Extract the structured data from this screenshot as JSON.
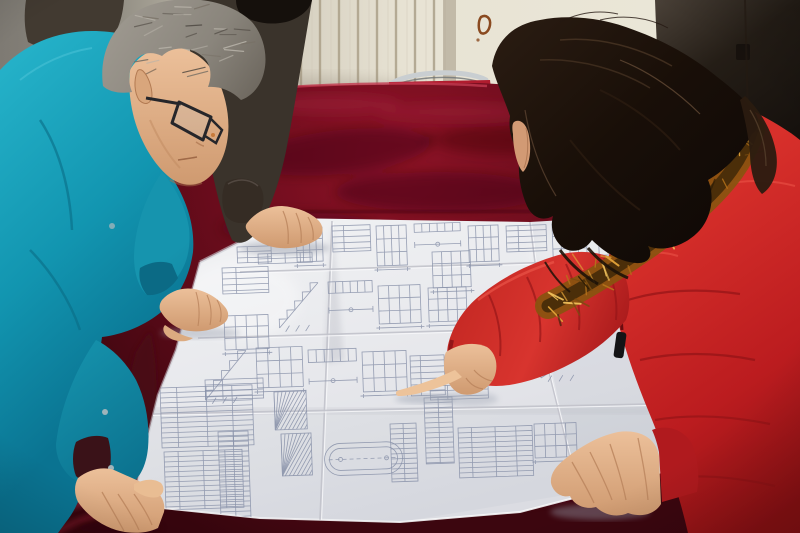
{
  "meta": {
    "description": "Photograph: two people leaning over a large folded architectural blueprint spread on a table covered with dark red velvet; a man in a teal work jacket with glasses on the left, a woman in a red fur-trimmed parka pointing at the drawing on the right, a third person in a dark coat partially visible behind.",
    "width": 800,
    "height": 533
  },
  "scene": {
    "people": [
      {
        "id": "engineer-left",
        "label": "man in teal work jacket, gray hair, dark glasses, leaning on the drawing"
      },
      {
        "id": "colleague-behind",
        "label": "person in dark coat behind, right hand resting on the drawing"
      },
      {
        "id": "woman-right",
        "label": "woman in red quilted parka with orange fur hood, long dark hair, pointing at the drawing"
      }
    ],
    "objects": [
      {
        "id": "blueprint",
        "label": "large folded construction drawing sheet with stair, beam and table details"
      },
      {
        "id": "velvet-table",
        "label": "table draped with dark red velvet cloth"
      },
      {
        "id": "red-chair",
        "label": "red upholstered chair with chrome tube frame behind the table"
      },
      {
        "id": "striped-wall",
        "label": "cream wall panel with vertical grooves"
      },
      {
        "id": "dark-door",
        "label": "dark door panel on the right"
      },
      {
        "id": "wall-stain",
        "label": "small rust stain on the wall"
      }
    ]
  },
  "palette": {
    "wall_left": "#868279",
    "wall_panel": "#d6d0c1",
    "wall_bright": "#e9e4d5",
    "wall_stripe": "#a89c85",
    "door_dark": "#17110d",
    "velvet": "#670c1c",
    "velvet_dark": "#3c060f",
    "velvet_bright": "#b62844",
    "chair_red": "#b01c2e",
    "chrome": "#c9ced1",
    "paper": "#e9eaee",
    "paper_shadow": "#c8c9d0",
    "ink": "#8790a8",
    "teal": "#18a0b8",
    "teal_shadow": "#0b6a85",
    "dark_coat": "#3a332b",
    "hair_gray": "#938e85",
    "hair_black": "#15100c",
    "fur_mid": "#8a5310",
    "fur_dark": "#3f2808",
    "coat_red": "#c4201f",
    "coat_red_dark": "#8e1216",
    "coat_red_light": "#ef5a4c",
    "skin": "#e2af87",
    "skin_shadow": "#b9835c",
    "stain": "#8a4a20"
  },
  "blueprint": {
    "folds": [
      [
        332,
        221,
        320,
        520
      ],
      [
        530,
        222,
        548,
        368
      ],
      [
        548,
        368,
        578,
        490
      ],
      [
        240,
        272,
        652,
        259
      ],
      [
        198,
        338,
        658,
        325
      ],
      [
        150,
        414,
        648,
        404
      ]
    ],
    "clusters": [
      {
        "x": 296,
        "y": 228,
        "w": 26,
        "h": 34,
        "t": "grid"
      },
      {
        "x": 332,
        "y": 226,
        "w": 38,
        "h": 26,
        "t": "rows"
      },
      {
        "x": 376,
        "y": 226,
        "w": 30,
        "h": 40,
        "t": "grid"
      },
      {
        "x": 414,
        "y": 224,
        "w": 46,
        "h": 28,
        "t": "beam"
      },
      {
        "x": 468,
        "y": 226,
        "w": 30,
        "h": 36,
        "t": "grid"
      },
      {
        "x": 506,
        "y": 226,
        "w": 40,
        "h": 26,
        "t": "rows"
      },
      {
        "x": 552,
        "y": 224,
        "w": 34,
        "h": 38,
        "t": "grid"
      },
      {
        "x": 598,
        "y": 221,
        "w": 42,
        "h": 52,
        "t": "grid"
      },
      {
        "x": 237,
        "y": 247,
        "w": 34,
        "h": 16,
        "t": "rows"
      },
      {
        "x": 258,
        "y": 254,
        "w": 54,
        "h": 10,
        "t": "table"
      },
      {
        "x": 222,
        "y": 268,
        "w": 46,
        "h": 26,
        "t": "rows"
      },
      {
        "x": 224,
        "y": 316,
        "w": 44,
        "h": 34,
        "t": "grid"
      },
      {
        "x": 278,
        "y": 284,
        "w": 40,
        "h": 44,
        "t": "stair"
      },
      {
        "x": 328,
        "y": 282,
        "w": 44,
        "h": 38,
        "t": "beam"
      },
      {
        "x": 378,
        "y": 286,
        "w": 42,
        "h": 38,
        "t": "grid"
      },
      {
        "x": 428,
        "y": 288,
        "w": 38,
        "h": 34,
        "t": "grid"
      },
      {
        "x": 432,
        "y": 252,
        "w": 38,
        "h": 36,
        "t": "grid"
      },
      {
        "x": 204,
        "y": 352,
        "w": 42,
        "h": 48,
        "t": "stair"
      },
      {
        "x": 256,
        "y": 348,
        "w": 46,
        "h": 40,
        "t": "grid"
      },
      {
        "x": 308,
        "y": 350,
        "w": 48,
        "h": 42,
        "t": "beam"
      },
      {
        "x": 362,
        "y": 352,
        "w": 44,
        "h": 40,
        "t": "grid"
      },
      {
        "x": 410,
        "y": 356,
        "w": 34,
        "h": 40,
        "t": "rows"
      },
      {
        "x": 520,
        "y": 318,
        "w": 28,
        "h": 38,
        "t": "ruler"
      },
      {
        "x": 540,
        "y": 352,
        "w": 44,
        "h": 26,
        "t": "stair"
      },
      {
        "x": 558,
        "y": 310,
        "w": 26,
        "h": 34,
        "t": "rows"
      },
      {
        "x": 430,
        "y": 386,
        "w": 58,
        "h": 14,
        "t": "rows"
      },
      {
        "x": 160,
        "y": 388,
        "w": 92,
        "h": 60,
        "t": "table"
      },
      {
        "x": 164,
        "y": 452,
        "w": 78,
        "h": 58,
        "t": "table"
      },
      {
        "x": 218,
        "y": 432,
        "w": 30,
        "h": 92,
        "t": "ruler"
      },
      {
        "x": 205,
        "y": 380,
        "w": 58,
        "h": 20,
        "t": "rows"
      },
      {
        "x": 274,
        "y": 392,
        "w": 32,
        "h": 38,
        "t": "hatch"
      },
      {
        "x": 281,
        "y": 434,
        "w": 30,
        "h": 42,
        "t": "hatch"
      },
      {
        "x": 324,
        "y": 444,
        "w": 78,
        "h": 32,
        "t": "oval"
      },
      {
        "x": 390,
        "y": 424,
        "w": 26,
        "h": 58,
        "t": "ruler"
      },
      {
        "x": 424,
        "y": 398,
        "w": 28,
        "h": 66,
        "t": "ruler"
      },
      {
        "x": 458,
        "y": 428,
        "w": 74,
        "h": 50,
        "t": "table"
      },
      {
        "x": 534,
        "y": 424,
        "w": 42,
        "h": 34,
        "t": "grid"
      }
    ]
  },
  "fur": {
    "p0": [
      548,
      306
    ],
    "p1": [
      660,
      238
    ],
    "p2": [
      752,
      128
    ],
    "count": 70,
    "spread": 13,
    "colors": [
      "#2e1d06",
      "#7a4c10",
      "#b5731a",
      "#e2a338",
      "#f3c35c"
    ]
  },
  "hair_gray_texture": {
    "cx": 182,
    "cy": 44,
    "rx": 68,
    "ry": 40,
    "count": 26,
    "colors": [
      "#565049",
      "#b8b3a9",
      "#776f64",
      "#45403a"
    ]
  }
}
